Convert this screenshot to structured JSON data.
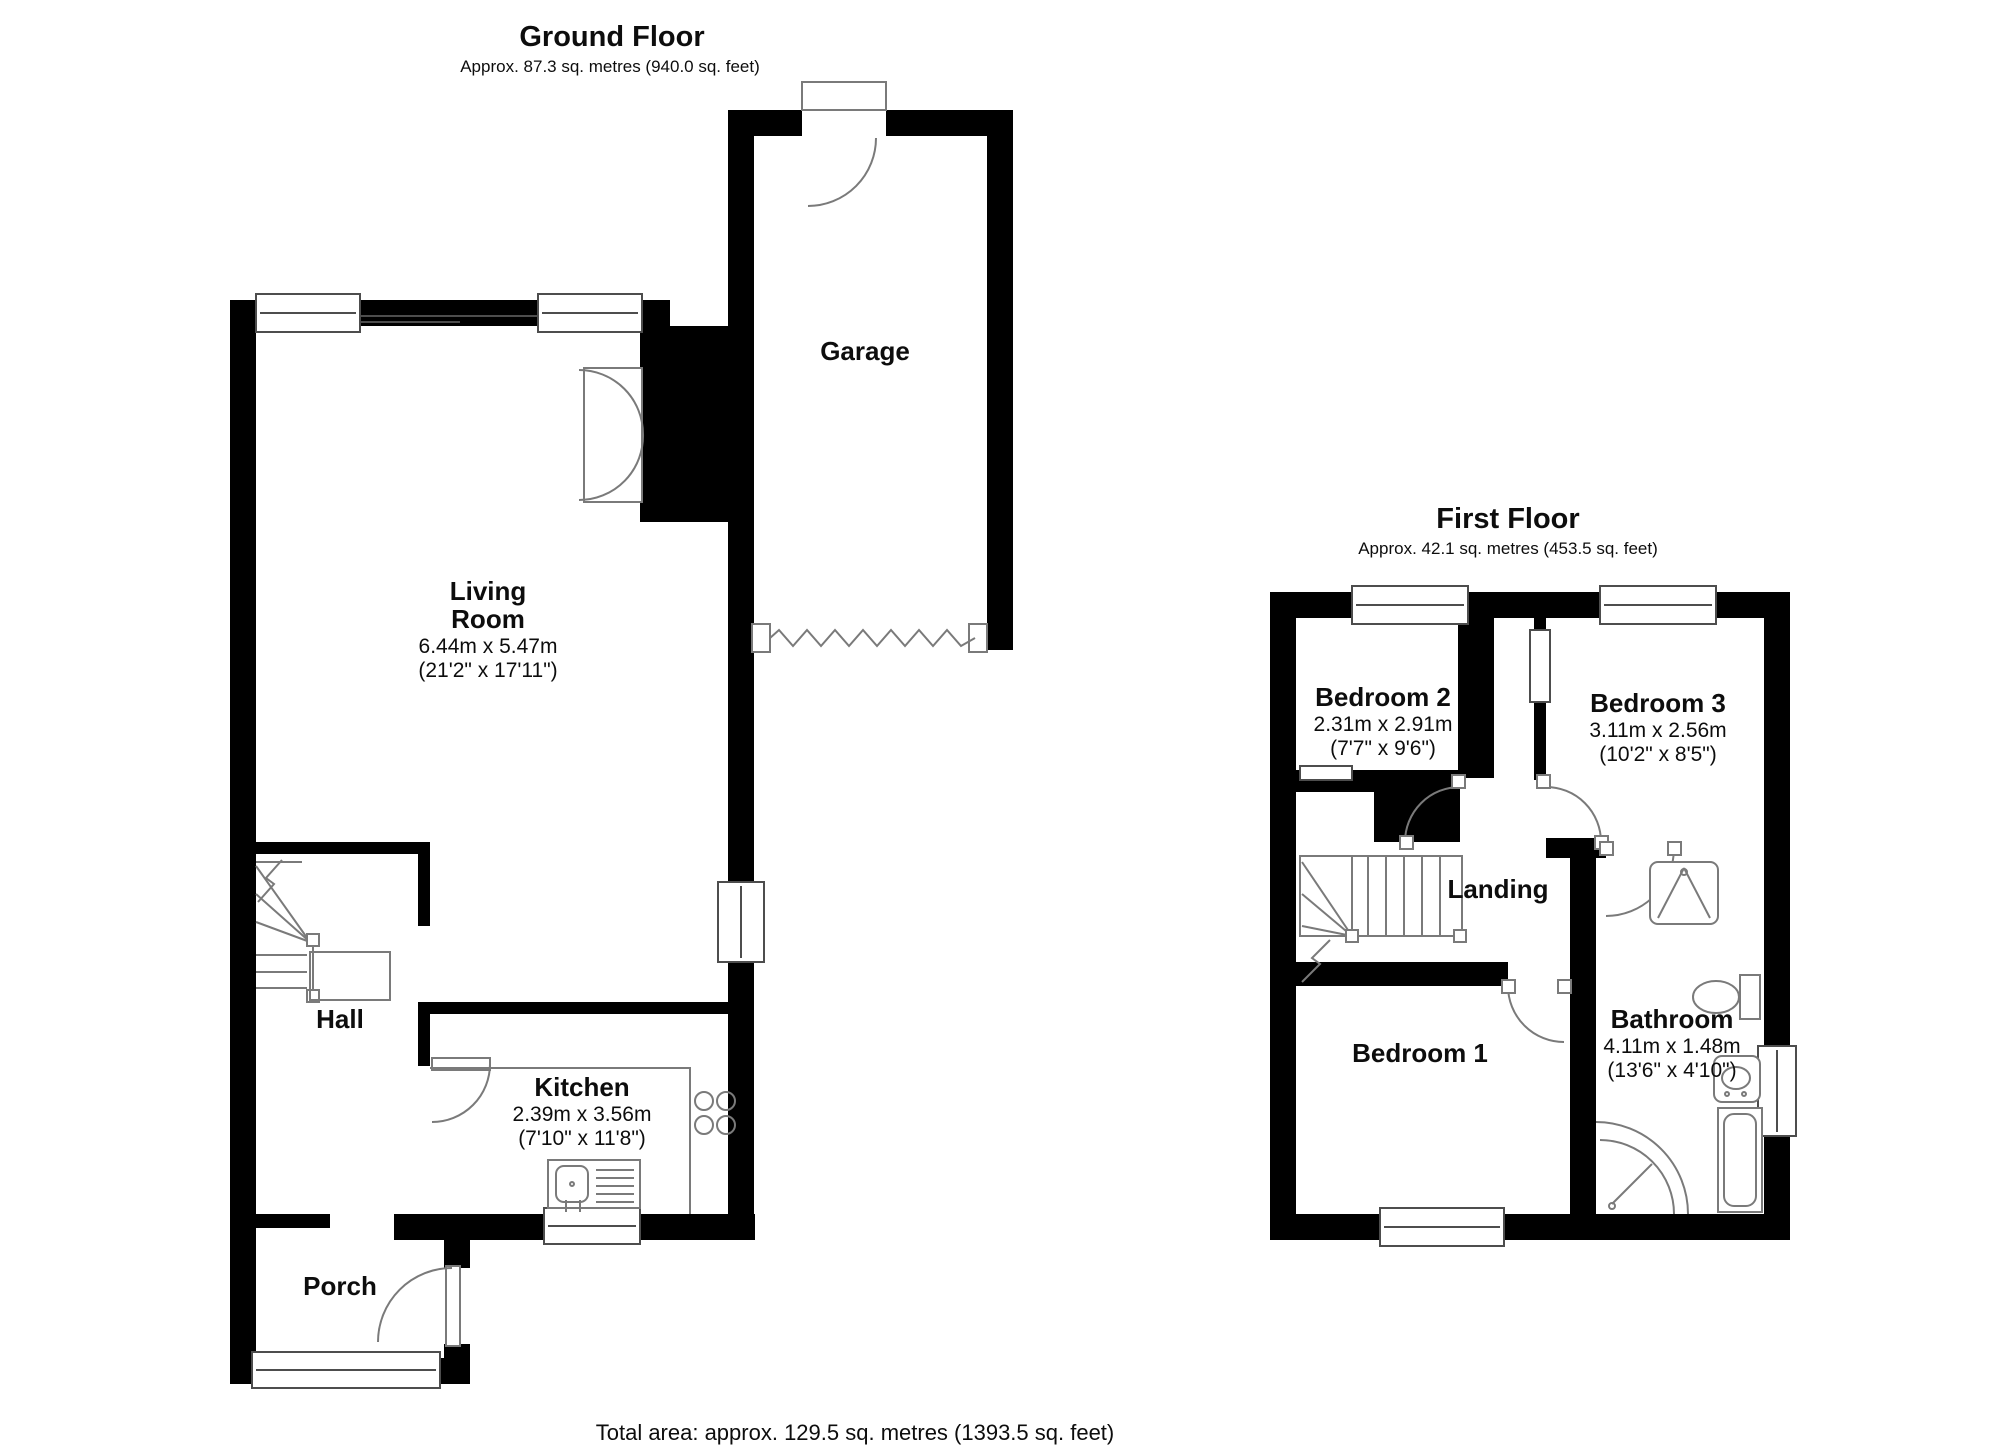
{
  "page": {
    "background": "#ffffff",
    "wall_color": "#000000",
    "fixture_line_color": "#7a7a7a"
  },
  "ground_floor": {
    "title": "Ground Floor",
    "subtitle": "Approx. 87.3 sq. metres (940.0 sq. feet)",
    "rooms": {
      "garage": {
        "name": "Garage"
      },
      "living_room": {
        "name_line1": "Living",
        "name_line2": "Room",
        "dims_m": "6.44m x 5.47m",
        "dims_ft": "(21'2\" x 17'11\")"
      },
      "hall": {
        "name": "Hall"
      },
      "kitchen": {
        "name": "Kitchen",
        "dims_m": "2.39m x 3.56m",
        "dims_ft": "(7'10\" x 11'8\")"
      },
      "porch": {
        "name": "Porch"
      }
    }
  },
  "first_floor": {
    "title": "First Floor",
    "subtitle": "Approx. 42.1 sq. metres (453.5 sq. feet)",
    "rooms": {
      "bedroom2": {
        "name": "Bedroom 2",
        "dims_m": "2.31m x 2.91m",
        "dims_ft": "(7'7\" x 9'6\")"
      },
      "bedroom3": {
        "name": "Bedroom 3",
        "dims_m": "3.11m x 2.56m",
        "dims_ft": "(10'2\" x 8'5\")"
      },
      "landing": {
        "name": "Landing"
      },
      "bedroom1": {
        "name": "Bedroom 1"
      },
      "bathroom": {
        "name": "Bathroom",
        "dims_m": "4.11m x 1.48m",
        "dims_ft": "(13'6\" x 4'10\")"
      }
    }
  },
  "footer": {
    "total_area": "Total area: approx. 129.5 sq. metres (1393.5 sq. feet)"
  }
}
